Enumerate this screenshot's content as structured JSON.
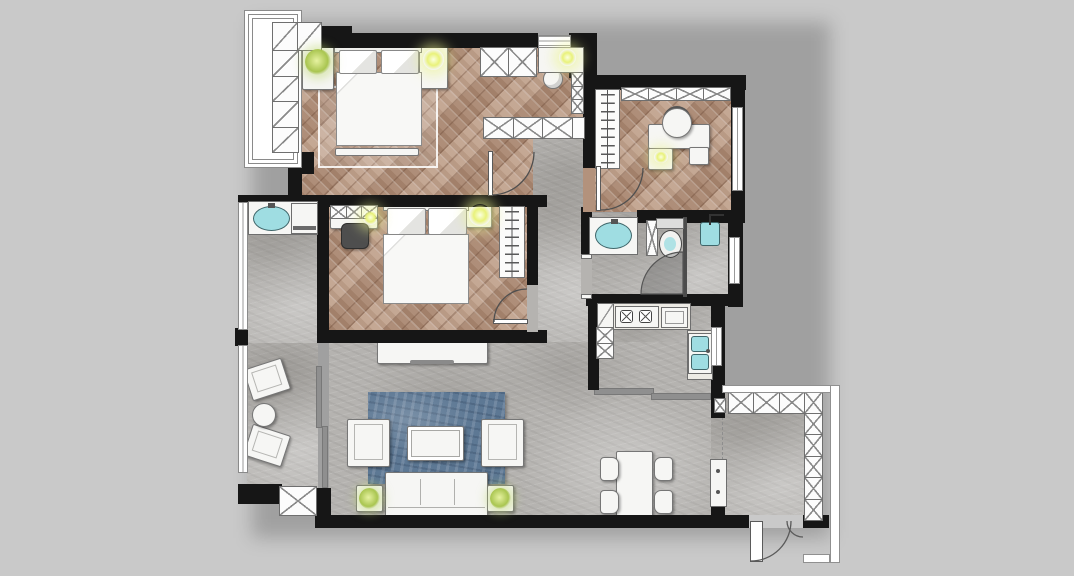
{
  "canvas": {
    "width": 1074,
    "height": 576,
    "view": "top-down residential floor plan rendering"
  },
  "palette": {
    "background": "#c9c9c9",
    "wall": "#161616",
    "wood": "#b3927c",
    "stone": "#b5b3b0",
    "rug": "#5d7894",
    "fixture_cyan": "#9fdde2",
    "lamp_yellow": "#e9f27a",
    "plant_green": "#a9c550",
    "furniture_white": "#f6f6f4",
    "line_gray": "#8a8a8a"
  },
  "rooms": [
    {
      "name": "master bedroom",
      "floor": "herringbone wood"
    },
    {
      "name": "walk-in closet / dressing area",
      "floor": "herringbone wood"
    },
    {
      "name": "study",
      "floor": "herringbone wood"
    },
    {
      "name": "second bedroom",
      "floor": "herringbone wood"
    },
    {
      "name": "bathroom",
      "floor": "stone tile"
    },
    {
      "name": "kitchen",
      "floor": "stone tile"
    },
    {
      "name": "hallway",
      "floor": "stone tile"
    },
    {
      "name": "laundry balcony",
      "floor": "stone tile"
    },
    {
      "name": "living room",
      "floor": "stone tile"
    },
    {
      "name": "dining area",
      "floor": "stone tile"
    },
    {
      "name": "entry foyer",
      "floor": "stone tile"
    },
    {
      "name": "leisure balcony",
      "floor": "stone tile"
    }
  ],
  "legend": {
    "furniture": [
      "double bed x2",
      "nightstands with lamps",
      "bay-window wardrobe",
      "x-panel wardrobes",
      "vanity with stool",
      "clothes-hanger wardrobes x2",
      "desk with office chair x2",
      "washbasin x2",
      "toilet",
      "shower head",
      "washing machine",
      "laundry sink",
      "gas stove",
      "kitchen double sink",
      "tv console",
      "blue area rug",
      "coffee table",
      "armchairs x2",
      "three-seat sofa",
      "side tables with plants",
      "lounge chairs x2",
      "round balcony table",
      "dining table with 4 chairs",
      "shoe cabinets",
      "entry double door"
    ],
    "door_arcs": [
      "suite door",
      "study door",
      "second bedroom door",
      "bathroom inner door",
      "entry door"
    ],
    "sliding_doors": [
      "kitchen slider",
      "balcony slider"
    ]
  }
}
